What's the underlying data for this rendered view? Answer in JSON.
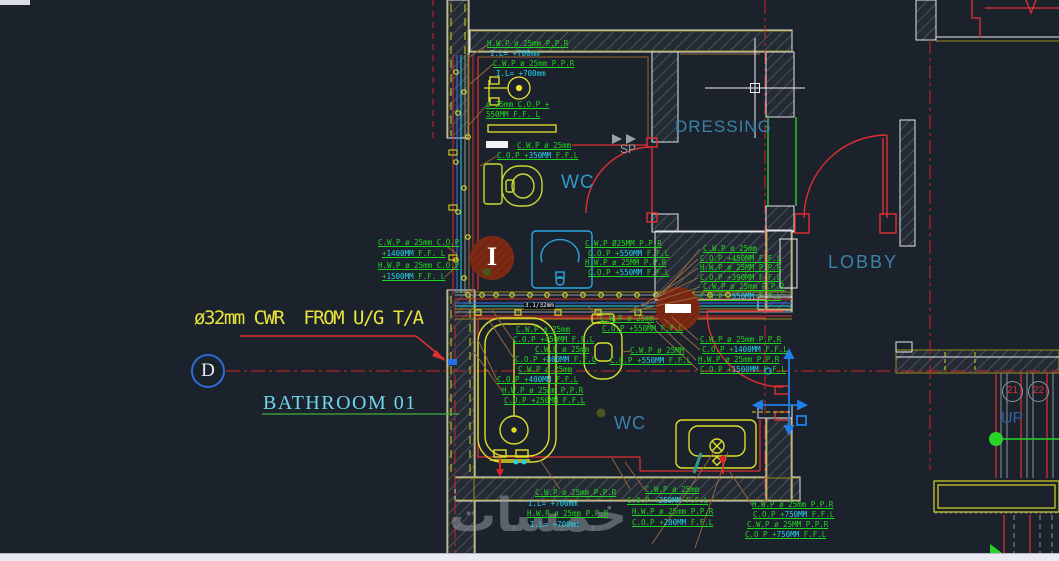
{
  "colors": {
    "background": "#1c222c",
    "annotation_green": "#21d421",
    "annotation_cyan": "#25d3ee",
    "wall_red": "#e03030",
    "fixture_yellow": "#dfdf28",
    "room_label_blue": "#3b82ab",
    "note_yellow": "#e8e23a",
    "grid_bubble_blue": "#2b6cd4"
  },
  "texts": {
    "supply_note": "ø32mm CWR  FROM U/G T/A",
    "grid_label": "D",
    "bathroom_title": "BATHROOM 01",
    "room_wc_top": "WC",
    "room_dressing": "DRESSING",
    "room_lobby": "LOBBY",
    "room_wc_bottom": "WC",
    "stair_up": "UP",
    "sp_marker": "SP",
    "column_marker": "I",
    "grid_21": "21",
    "grid_22": "22",
    "dim_note": "3.1/32mm",
    "watermark": "خمسات"
  },
  "annotations": [
    {
      "x": 487,
      "y": 40,
      "s": [
        [
          "g",
          "H.W.P ø 25mm P.P.R"
        ]
      ]
    },
    {
      "x": 490,
      "y": 50,
      "s": [
        [
          "c",
          "I.L= +700mm"
        ]
      ]
    },
    {
      "x": 493,
      "y": 60,
      "s": [
        [
          "g",
          "C.W.P ø 25mm P.P.R"
        ]
      ]
    },
    {
      "x": 496,
      "y": 70,
      "s": [
        [
          "c",
          "I.L= +700mm"
        ]
      ]
    },
    {
      "x": 486,
      "y": 101,
      "s": [
        [
          "g",
          "ø 25mm C.O.P +"
        ]
      ]
    },
    {
      "x": 486,
      "y": 111,
      "s": [
        [
          "g",
          "550MM F.F. L"
        ]
      ]
    },
    {
      "x": 517,
      "y": 142,
      "s": [
        [
          "g",
          "C.W.P ø 25mm"
        ]
      ]
    },
    {
      "x": 497,
      "y": 152,
      "s": [
        [
          "g",
          "C.O.P +"
        ],
        [
          "c",
          "350MM"
        ],
        [
          "g",
          " F.F.L"
        ]
      ]
    },
    {
      "x": 585,
      "y": 240,
      "s": [
        [
          "g",
          "C.W.P Ø25MM P.P.R"
        ]
      ]
    },
    {
      "x": 588,
      "y": 250,
      "s": [
        [
          "g",
          "C.O.P +"
        ],
        [
          "c",
          "550MM"
        ],
        [
          "g",
          " F.F.L"
        ]
      ]
    },
    {
      "x": 585,
      "y": 259,
      "s": [
        [
          "g",
          "H.W.P ø 25MM P.P.R"
        ]
      ]
    },
    {
      "x": 588,
      "y": 269,
      "s": [
        [
          "g",
          "C.O.P +"
        ],
        [
          "c",
          "550MM"
        ],
        [
          "g",
          " F.F.L"
        ]
      ]
    },
    {
      "x": 378,
      "y": 239,
      "s": [
        [
          "g",
          "C.W.P ø 25mm C.O.P"
        ]
      ]
    },
    {
      "x": 382,
      "y": 250,
      "s": [
        [
          "g",
          "+"
        ],
        [
          "c",
          "1400MM"
        ],
        [
          "g",
          " F.F. L"
        ]
      ]
    },
    {
      "x": 378,
      "y": 262,
      "s": [
        [
          "g",
          "H.W.P ø 25mm C.O.P"
        ]
      ]
    },
    {
      "x": 382,
      "y": 273,
      "s": [
        [
          "g",
          "+"
        ],
        [
          "c",
          "1500MM"
        ],
        [
          "g",
          " F.F. L"
        ]
      ]
    },
    {
      "x": 703,
      "y": 245,
      "s": [
        [
          "g",
          "C.W.P ø 25mm"
        ]
      ]
    },
    {
      "x": 700,
      "y": 255,
      "s": [
        [
          "g",
          "C.O.P +450MM F.F.L"
        ]
      ]
    },
    {
      "x": 700,
      "y": 264,
      "s": [
        [
          "g",
          "H.W.P ø 25MM P.P.R"
        ]
      ]
    },
    {
      "x": 700,
      "y": 274,
      "s": [
        [
          "g",
          "C.O.P +390MM F.F.L"
        ]
      ]
    },
    {
      "x": 703,
      "y": 283,
      "s": [
        [
          "g",
          "C.W.P ø 25mm P.P.R"
        ]
      ]
    },
    {
      "x": 700,
      "y": 293,
      "s": [
        [
          "g",
          "C.O.P +"
        ],
        [
          "c",
          "550MM"
        ],
        [
          "g",
          " F.F.L"
        ]
      ]
    },
    {
      "x": 700,
      "y": 336,
      "s": [
        [
          "g",
          "C.W.P ø 25mm P.P.R"
        ]
      ]
    },
    {
      "x": 702,
      "y": 346,
      "s": [
        [
          "g",
          "C.O.P +"
        ],
        [
          "c",
          "1400MM"
        ],
        [
          "g",
          " F.F.L"
        ]
      ]
    },
    {
      "x": 698,
      "y": 356,
      "s": [
        [
          "g",
          "H.W.P ø 25mm P.P.R"
        ]
      ]
    },
    {
      "x": 700,
      "y": 366,
      "s": [
        [
          "g",
          "C.O.P +"
        ],
        [
          "c",
          "1500MM"
        ],
        [
          "g",
          " F.F.L"
        ]
      ]
    },
    {
      "x": 516,
      "y": 326,
      "s": [
        [
          "g",
          "C.W.P ø 25mm"
        ]
      ]
    },
    {
      "x": 513,
      "y": 336,
      "s": [
        [
          "g",
          "C.O.P +450MM F.F.L"
        ]
      ]
    },
    {
      "x": 535,
      "y": 346,
      "s": [
        [
          "g",
          "C.W.P ø 25mm"
        ]
      ]
    },
    {
      "x": 515,
      "y": 356,
      "s": [
        [
          "g",
          "C.O.P +"
        ],
        [
          "c",
          "800MM"
        ],
        [
          "g",
          " F.F.L"
        ]
      ]
    },
    {
      "x": 518,
      "y": 366,
      "s": [
        [
          "g",
          "C.W.P ø 25mm"
        ]
      ]
    },
    {
      "x": 497,
      "y": 376,
      "s": [
        [
          "g",
          "C.O.P +"
        ],
        [
          "c",
          "400MM"
        ],
        [
          "g",
          " F.F.L"
        ]
      ]
    },
    {
      "x": 502,
      "y": 387,
      "s": [
        [
          "g",
          "H.W.P ø 25mm P.P.R"
        ]
      ]
    },
    {
      "x": 504,
      "y": 397,
      "s": [
        [
          "g",
          "C.O.P +250MM F.F.L"
        ]
      ]
    },
    {
      "x": 600,
      "y": 315,
      "s": [
        [
          "g",
          "C.W.P ø 25mm"
        ]
      ]
    },
    {
      "x": 602,
      "y": 325,
      "s": [
        [
          "g",
          "C.O.P +550MM F.F.L"
        ]
      ]
    },
    {
      "x": 630,
      "y": 347,
      "s": [
        [
          "g",
          "C.W.P ø 25MM"
        ]
      ]
    },
    {
      "x": 610,
      "y": 357,
      "s": [
        [
          "g",
          "C.O.P +"
        ],
        [
          "c",
          "550MM"
        ],
        [
          "g",
          " F.F.L"
        ]
      ]
    },
    {
      "x": 535,
      "y": 489,
      "s": [
        [
          "g",
          "C.W.P ø 25mm P.P.R"
        ]
      ]
    },
    {
      "x": 528,
      "y": 500,
      "s": [
        [
          "c",
          "I.L= +700mm"
        ]
      ]
    },
    {
      "x": 527,
      "y": 510,
      "s": [
        [
          "g",
          "H.W.P ø 25mm P.P.R"
        ]
      ]
    },
    {
      "x": 530,
      "y": 521,
      "s": [
        [
          "c",
          "I.L= +700mm"
        ]
      ]
    },
    {
      "x": 645,
      "y": 486,
      "s": [
        [
          "g",
          "C.W.P ø 25mm"
        ]
      ]
    },
    {
      "x": 627,
      "y": 497,
      "s": [
        [
          "g",
          "C.O.P +"
        ],
        [
          "c",
          "250MM"
        ],
        [
          "g",
          " F.F.L"
        ]
      ]
    },
    {
      "x": 632,
      "y": 508,
      "s": [
        [
          "g",
          "H.W.P ø 25mm P.P.R"
        ]
      ]
    },
    {
      "x": 632,
      "y": 519,
      "s": [
        [
          "g",
          "C.O.P +"
        ],
        [
          "c",
          "200MM"
        ],
        [
          "g",
          " F.F.L"
        ]
      ]
    },
    {
      "x": 752,
      "y": 501,
      "s": [
        [
          "g",
          "H.W.P ø 25mm P.P.R"
        ]
      ]
    },
    {
      "x": 753,
      "y": 511,
      "s": [
        [
          "g",
          "C.O.P +"
        ],
        [
          "c",
          "750MM"
        ],
        [
          "g",
          " F.F.L"
        ]
      ]
    },
    {
      "x": 747,
      "y": 521,
      "s": [
        [
          "g",
          "C.W.P ø 25MM P.P.R"
        ]
      ]
    },
    {
      "x": 745,
      "y": 531,
      "s": [
        [
          "g",
          "C.O P +"
        ],
        [
          "c",
          "750MM"
        ],
        [
          "g",
          " F.F.L"
        ]
      ]
    }
  ]
}
